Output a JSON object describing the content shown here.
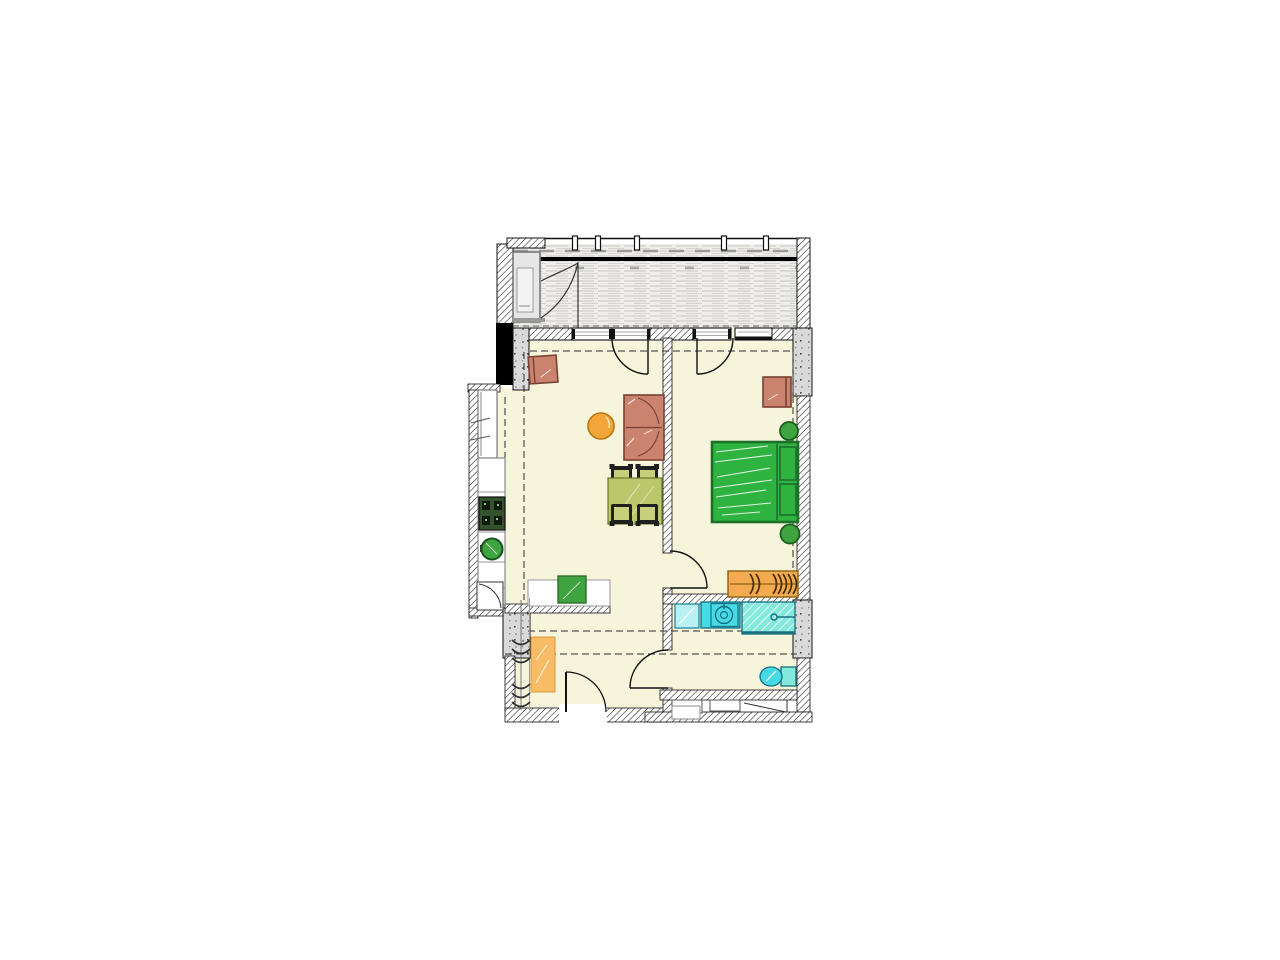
{
  "plan": {
    "kind": "apartment-floor-plan",
    "rooms": [
      {
        "name": "balcony"
      },
      {
        "name": "living-room"
      },
      {
        "name": "kitchen"
      },
      {
        "name": "bedroom"
      },
      {
        "name": "bathroom"
      },
      {
        "name": "hallway"
      }
    ],
    "furniture": [
      {
        "name": "balcony-cabinet",
        "room": "balcony"
      },
      {
        "name": "armchair",
        "room": "living-room"
      },
      {
        "name": "corner-sofa",
        "room": "living-room"
      },
      {
        "name": "round-side-table",
        "room": "living-room"
      },
      {
        "name": "dining-table-with-four-chairs",
        "room": "living-room"
      },
      {
        "name": "tall-cabinet",
        "room": "kitchen"
      },
      {
        "name": "counter-with-stove-and-sink",
        "room": "kitchen"
      },
      {
        "name": "sideboard",
        "room": "kitchen"
      },
      {
        "name": "double-bed-with-pillows",
        "room": "bedroom"
      },
      {
        "name": "armchair",
        "room": "bedroom"
      },
      {
        "name": "wardrobe-with-hangers",
        "room": "bedroom"
      },
      {
        "name": "plant",
        "room": "bedroom"
      },
      {
        "name": "plant",
        "room": "bedroom"
      },
      {
        "name": "washing-machine",
        "room": "bathroom"
      },
      {
        "name": "washbasin",
        "room": "bathroom"
      },
      {
        "name": "shower",
        "room": "bathroom"
      },
      {
        "name": "toilet",
        "room": "bathroom"
      },
      {
        "name": "wardrobe",
        "room": "hallway"
      },
      {
        "name": "coat-rack",
        "room": "hallway"
      }
    ],
    "colors": {
      "floor": "#f7f4dc",
      "deck": "#efeeea",
      "beam": "#000000",
      "salmon": "#c9836e",
      "salmonEdge": "#7a4034",
      "orangeTable": "#f2a63a",
      "olive": "#bcc76b",
      "oliveLight": "#c6d07a",
      "chair": "#1f1f1f",
      "greenBed": "#2eb340",
      "greenEdge": "#1d6f2a",
      "greenItem": "#3fa33f",
      "orangeWardrobe": "#f4ab50",
      "orangeHall": "#f8bc66",
      "cyan": "#46d9e6",
      "cyanLight": "#b9f0f4",
      "cyanShower": "#83e9dd",
      "cyanEdge": "#17707e",
      "stove": "#35522f",
      "cabinetGray": "#e6e6e6"
    }
  }
}
